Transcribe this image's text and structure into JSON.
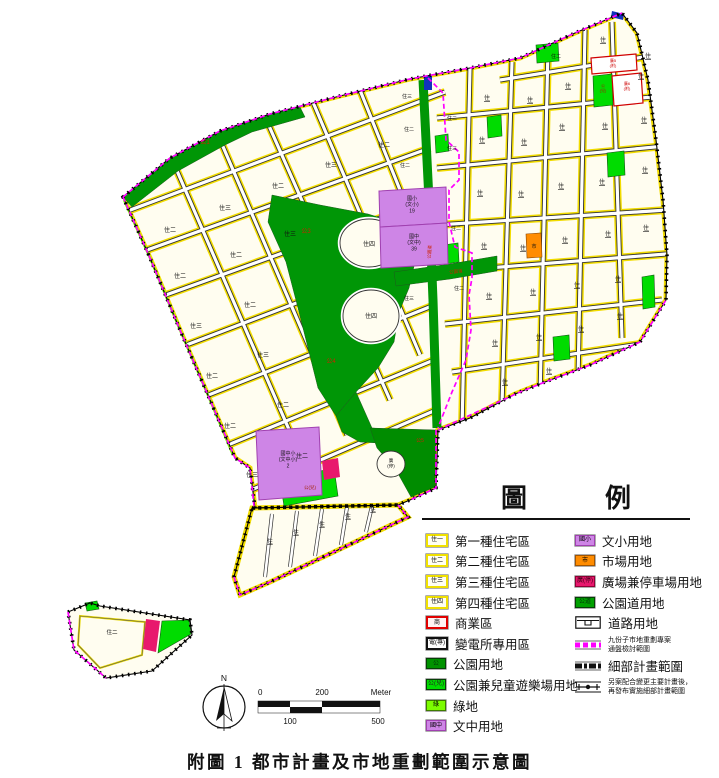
{
  "title": "附圖 1 都市計畫及市地重劃範圍示意圖",
  "compass": {
    "north_label": "N"
  },
  "scale_bar": {
    "top_labels": [
      "0",
      "200",
      "Meter"
    ],
    "bottom_labels": [
      "100",
      "500"
    ]
  },
  "legend": {
    "heading_chars": [
      "圖",
      "例"
    ],
    "left_items": [
      {
        "code": "住一",
        "label": "第一種住宅區"
      },
      {
        "code": "住二",
        "label": "第二種住宅區"
      },
      {
        "code": "住三",
        "label": "第三種住宅區"
      },
      {
        "code": "住四",
        "label": "第四種住宅區"
      },
      {
        "code": "商",
        "label": "商業區"
      },
      {
        "code": "電(專)",
        "label": "變電所專用區"
      },
      {
        "code": "公",
        "label": "公園用地"
      },
      {
        "code": "公(兒)",
        "label": "公園兼兒童遊樂場用地"
      },
      {
        "code": "綠",
        "label": "綠地"
      },
      {
        "code": "國中",
        "label": "文中用地"
      }
    ],
    "right_items": [
      {
        "code": "國小",
        "label": "文小用地"
      },
      {
        "code": "市",
        "label": "市場用地"
      },
      {
        "code": "廣(停)",
        "label": "廣場兼停車場用地"
      },
      {
        "code": "公道",
        "label": "公園道用地"
      },
      {
        "code": "",
        "label": "道路用地"
      },
      {
        "code": "",
        "label_lines": [
          "九份子市地重劃專案",
          "通盤檢討範圍"
        ]
      },
      {
        "code": "",
        "label": "細部計畫範圍"
      },
      {
        "code": "",
        "label_lines": [
          "另案配合變更主要計畫後，",
          "再發布實施細部計畫範圍"
        ]
      }
    ]
  },
  "map": {
    "colors": {
      "parcel": "#FFFDF0",
      "roadcase": "#333333",
      "yellow": "#F2DC00",
      "park": "#009606",
      "park5": "#008C00",
      "kids": "#00DC00",
      "lawn": "#7CFC00",
      "school": "#CE85E6",
      "schoolline": "#A040B0",
      "market": "#FF8C00",
      "plaza": "#E8186D",
      "power": "#1133BB",
      "magenta": "#FF00FF",
      "red": "#D00000"
    },
    "labels": [
      {
        "t": "公1",
        "x": 205,
        "y": 144,
        "s": 6,
        "c": "#CC2200"
      },
      {
        "t": "公3",
        "x": 306,
        "y": 233,
        "s": 6,
        "c": "#CC2200"
      },
      {
        "t": "公4",
        "x": 331,
        "y": 363,
        "s": 6,
        "c": "#CC2200"
      },
      {
        "t": "公5",
        "x": 420,
        "y": 442,
        "s": 5,
        "c": "#CC2200"
      },
      {
        "t": "公園道",
        "x": 431,
        "y": 252,
        "s": 4.5,
        "c": "#CC2200",
        "r": -86
      },
      {
        "t": "公園道",
        "x": 456,
        "y": 273,
        "s": 4.5,
        "c": "#CC2200",
        "r": -6
      },
      {
        "lines": [
          "國小",
          "(文小)",
          "19"
        ],
        "x": 412,
        "y": 200,
        "s": 5
      },
      {
        "lines": [
          "國中",
          "(文中)",
          "39"
        ],
        "x": 414,
        "y": 238,
        "s": 5
      },
      {
        "lines": [
          "國中小",
          "(文中小)",
          "2"
        ],
        "x": 288,
        "y": 455,
        "s": 5
      },
      {
        "t": "市",
        "x": 534,
        "y": 248,
        "s": 5
      },
      {
        "lines": [
          "廣5",
          "(附)"
        ],
        "x": 613,
        "y": 62,
        "s": 4,
        "c": "#CC0000"
      },
      {
        "lines": [
          "廣6",
          "(附)"
        ],
        "x": 627,
        "y": 85,
        "s": 4,
        "c": "#CC0000"
      },
      {
        "lines": [
          "公",
          "(兒)"
        ],
        "x": 603,
        "y": 87,
        "s": 4,
        "c": "#A02000"
      },
      {
        "t": "公(兒)",
        "x": 310,
        "y": 489,
        "s": 4.5,
        "c": "#A02000"
      },
      {
        "lines": [
          "廣",
          "(停)"
        ],
        "x": 391,
        "y": 462,
        "s": 4.5
      },
      {
        "t": "住四",
        "x": 369,
        "y": 246,
        "s": 6
      },
      {
        "t": "住四",
        "x": 371,
        "y": 318,
        "s": 6
      },
      {
        "t": "住二",
        "x": 170,
        "y": 232,
        "s": 6
      },
      {
        "t": "住三",
        "x": 225,
        "y": 210,
        "s": 6
      },
      {
        "t": "住二",
        "x": 278,
        "y": 188,
        "s": 6
      },
      {
        "t": "住三",
        "x": 331,
        "y": 167,
        "s": 6
      },
      {
        "t": "住二",
        "x": 384,
        "y": 147,
        "s": 6
      },
      {
        "t": "住二",
        "x": 180,
        "y": 278,
        "s": 6
      },
      {
        "t": "住二",
        "x": 236,
        "y": 257,
        "s": 6
      },
      {
        "t": "住三",
        "x": 290,
        "y": 236,
        "s": 6
      },
      {
        "t": "住三",
        "x": 196,
        "y": 328,
        "s": 6
      },
      {
        "t": "住二",
        "x": 250,
        "y": 307,
        "s": 6
      },
      {
        "t": "住二",
        "x": 212,
        "y": 378,
        "s": 6
      },
      {
        "t": "住三",
        "x": 263,
        "y": 357,
        "s": 6
      },
      {
        "t": "住二",
        "x": 230,
        "y": 428,
        "s": 6
      },
      {
        "t": "住二",
        "x": 283,
        "y": 407,
        "s": 6
      },
      {
        "t": "住三",
        "x": 252,
        "y": 477,
        "s": 6
      },
      {
        "t": "住二",
        "x": 302,
        "y": 458,
        "s": 6
      },
      {
        "t": "住三",
        "x": 407,
        "y": 98,
        "s": 5
      },
      {
        "t": "住二",
        "x": 409,
        "y": 131,
        "s": 5
      },
      {
        "t": "住二",
        "x": 405,
        "y": 167,
        "s": 5
      },
      {
        "t": "住三",
        "x": 409,
        "y": 300,
        "s": 5
      },
      {
        "t": "住二",
        "x": 556,
        "y": 58,
        "s": 5
      },
      {
        "t": "住二",
        "x": 452,
        "y": 120,
        "s": 5
      },
      {
        "t": "住三",
        "x": 452,
        "y": 150,
        "s": 5
      },
      {
        "t": "住二",
        "x": 456,
        "y": 230,
        "s": 5
      },
      {
        "t": "住二",
        "x": 459,
        "y": 290,
        "s": 5
      },
      {
        "t": "住",
        "x": 487,
        "y": 100,
        "s": 6,
        "u": true
      },
      {
        "t": "住",
        "x": 530,
        "y": 102,
        "s": 6,
        "u": true
      },
      {
        "t": "住",
        "x": 568,
        "y": 88,
        "s": 6,
        "u": true
      },
      {
        "t": "住",
        "x": 603,
        "y": 42,
        "s": 6,
        "u": true
      },
      {
        "t": "住",
        "x": 641,
        "y": 78,
        "s": 6,
        "u": true
      },
      {
        "t": "住",
        "x": 648,
        "y": 58,
        "s": 6,
        "u": true
      },
      {
        "t": "住",
        "x": 482,
        "y": 142,
        "s": 6,
        "u": true
      },
      {
        "t": "住",
        "x": 524,
        "y": 144,
        "s": 6,
        "u": true
      },
      {
        "t": "住",
        "x": 562,
        "y": 129,
        "s": 6,
        "u": true
      },
      {
        "t": "住",
        "x": 605,
        "y": 128,
        "s": 6,
        "u": true
      },
      {
        "t": "住",
        "x": 644,
        "y": 122,
        "s": 6,
        "u": true
      },
      {
        "t": "住",
        "x": 480,
        "y": 195,
        "s": 6,
        "u": true
      },
      {
        "t": "住",
        "x": 521,
        "y": 196,
        "s": 6,
        "u": true
      },
      {
        "t": "住",
        "x": 561,
        "y": 188,
        "s": 6,
        "u": true
      },
      {
        "t": "住",
        "x": 602,
        "y": 184,
        "s": 6,
        "u": true
      },
      {
        "t": "住",
        "x": 645,
        "y": 172,
        "s": 6,
        "u": true
      },
      {
        "t": "住",
        "x": 484,
        "y": 248,
        "s": 6,
        "u": true
      },
      {
        "t": "住",
        "x": 523,
        "y": 250,
        "s": 6,
        "u": true
      },
      {
        "t": "住",
        "x": 565,
        "y": 242,
        "s": 6,
        "u": true
      },
      {
        "t": "住",
        "x": 608,
        "y": 236,
        "s": 6,
        "u": true
      },
      {
        "t": "住",
        "x": 646,
        "y": 230,
        "s": 6,
        "u": true
      },
      {
        "t": "住",
        "x": 489,
        "y": 298,
        "s": 6,
        "u": true
      },
      {
        "t": "住",
        "x": 533,
        "y": 294,
        "s": 6,
        "u": true
      },
      {
        "t": "住",
        "x": 577,
        "y": 287,
        "s": 6,
        "u": true
      },
      {
        "t": "住",
        "x": 618,
        "y": 281,
        "s": 6,
        "u": true
      },
      {
        "t": "住",
        "x": 495,
        "y": 345,
        "s": 6,
        "u": true
      },
      {
        "t": "住",
        "x": 539,
        "y": 339,
        "s": 6,
        "u": true
      },
      {
        "t": "住",
        "x": 581,
        "y": 331,
        "s": 6,
        "u": true
      },
      {
        "t": "住",
        "x": 620,
        "y": 318,
        "s": 6,
        "u": true
      },
      {
        "t": "住",
        "x": 505,
        "y": 384,
        "s": 6,
        "u": true
      },
      {
        "t": "住",
        "x": 549,
        "y": 373,
        "s": 6,
        "u": true
      },
      {
        "t": "住",
        "x": 270,
        "y": 543,
        "s": 5.5,
        "u": true
      },
      {
        "t": "住",
        "x": 296,
        "y": 534,
        "s": 5.5,
        "u": true
      },
      {
        "t": "住",
        "x": 322,
        "y": 526,
        "s": 5.5,
        "u": true
      },
      {
        "t": "住",
        "x": 348,
        "y": 518,
        "s": 5.5,
        "u": true
      },
      {
        "t": "住",
        "x": 373,
        "y": 511,
        "s": 5.5,
        "u": true
      },
      {
        "t": "住二",
        "x": 112,
        "y": 634,
        "s": 5.5
      }
    ]
  }
}
